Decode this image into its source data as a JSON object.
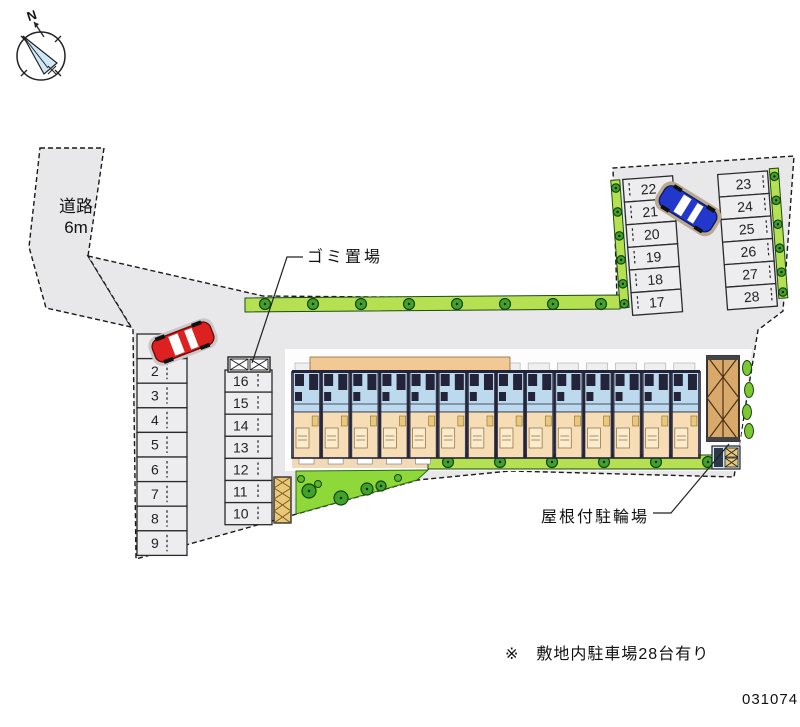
{
  "compass": {
    "north_label": "N"
  },
  "labels": {
    "road_line1": "道路",
    "road_line2": "6m",
    "garbage": "ゴミ置場",
    "covered_bicycle_parking": "屋根付駐輪場",
    "site_note": "※　敷地内駐車場28台有り",
    "plan_number": "031074"
  },
  "parking": {
    "left_column_spaces": [
      "1",
      "2",
      "3",
      "4",
      "5",
      "6",
      "7",
      "8",
      "9"
    ],
    "middle_column_spaces": [
      "16",
      "15",
      "14",
      "13",
      "12",
      "11",
      "10"
    ],
    "upper_left_column_spaces": [
      "22",
      "21",
      "20",
      "19",
      "18",
      "17"
    ],
    "upper_right_column_spaces": [
      "23",
      "24",
      "25",
      "26",
      "27",
      "28"
    ]
  },
  "colors": {
    "site_fill": "#e8e8ea",
    "stall_fill": "#ededef",
    "hedge_green": "#b5e052",
    "tree_green": "#3fa32a",
    "tree_outline": "#17430e",
    "garden_green": "#8fd83a",
    "building_blue": "#bcd9ee",
    "building_tan": "#f6ddb5",
    "roof_tan": "#f2c894",
    "shed_tan": "#d9a96b",
    "car_red": "#dd2020",
    "car_blue": "#2238cc",
    "line_dark": "#222222"
  }
}
